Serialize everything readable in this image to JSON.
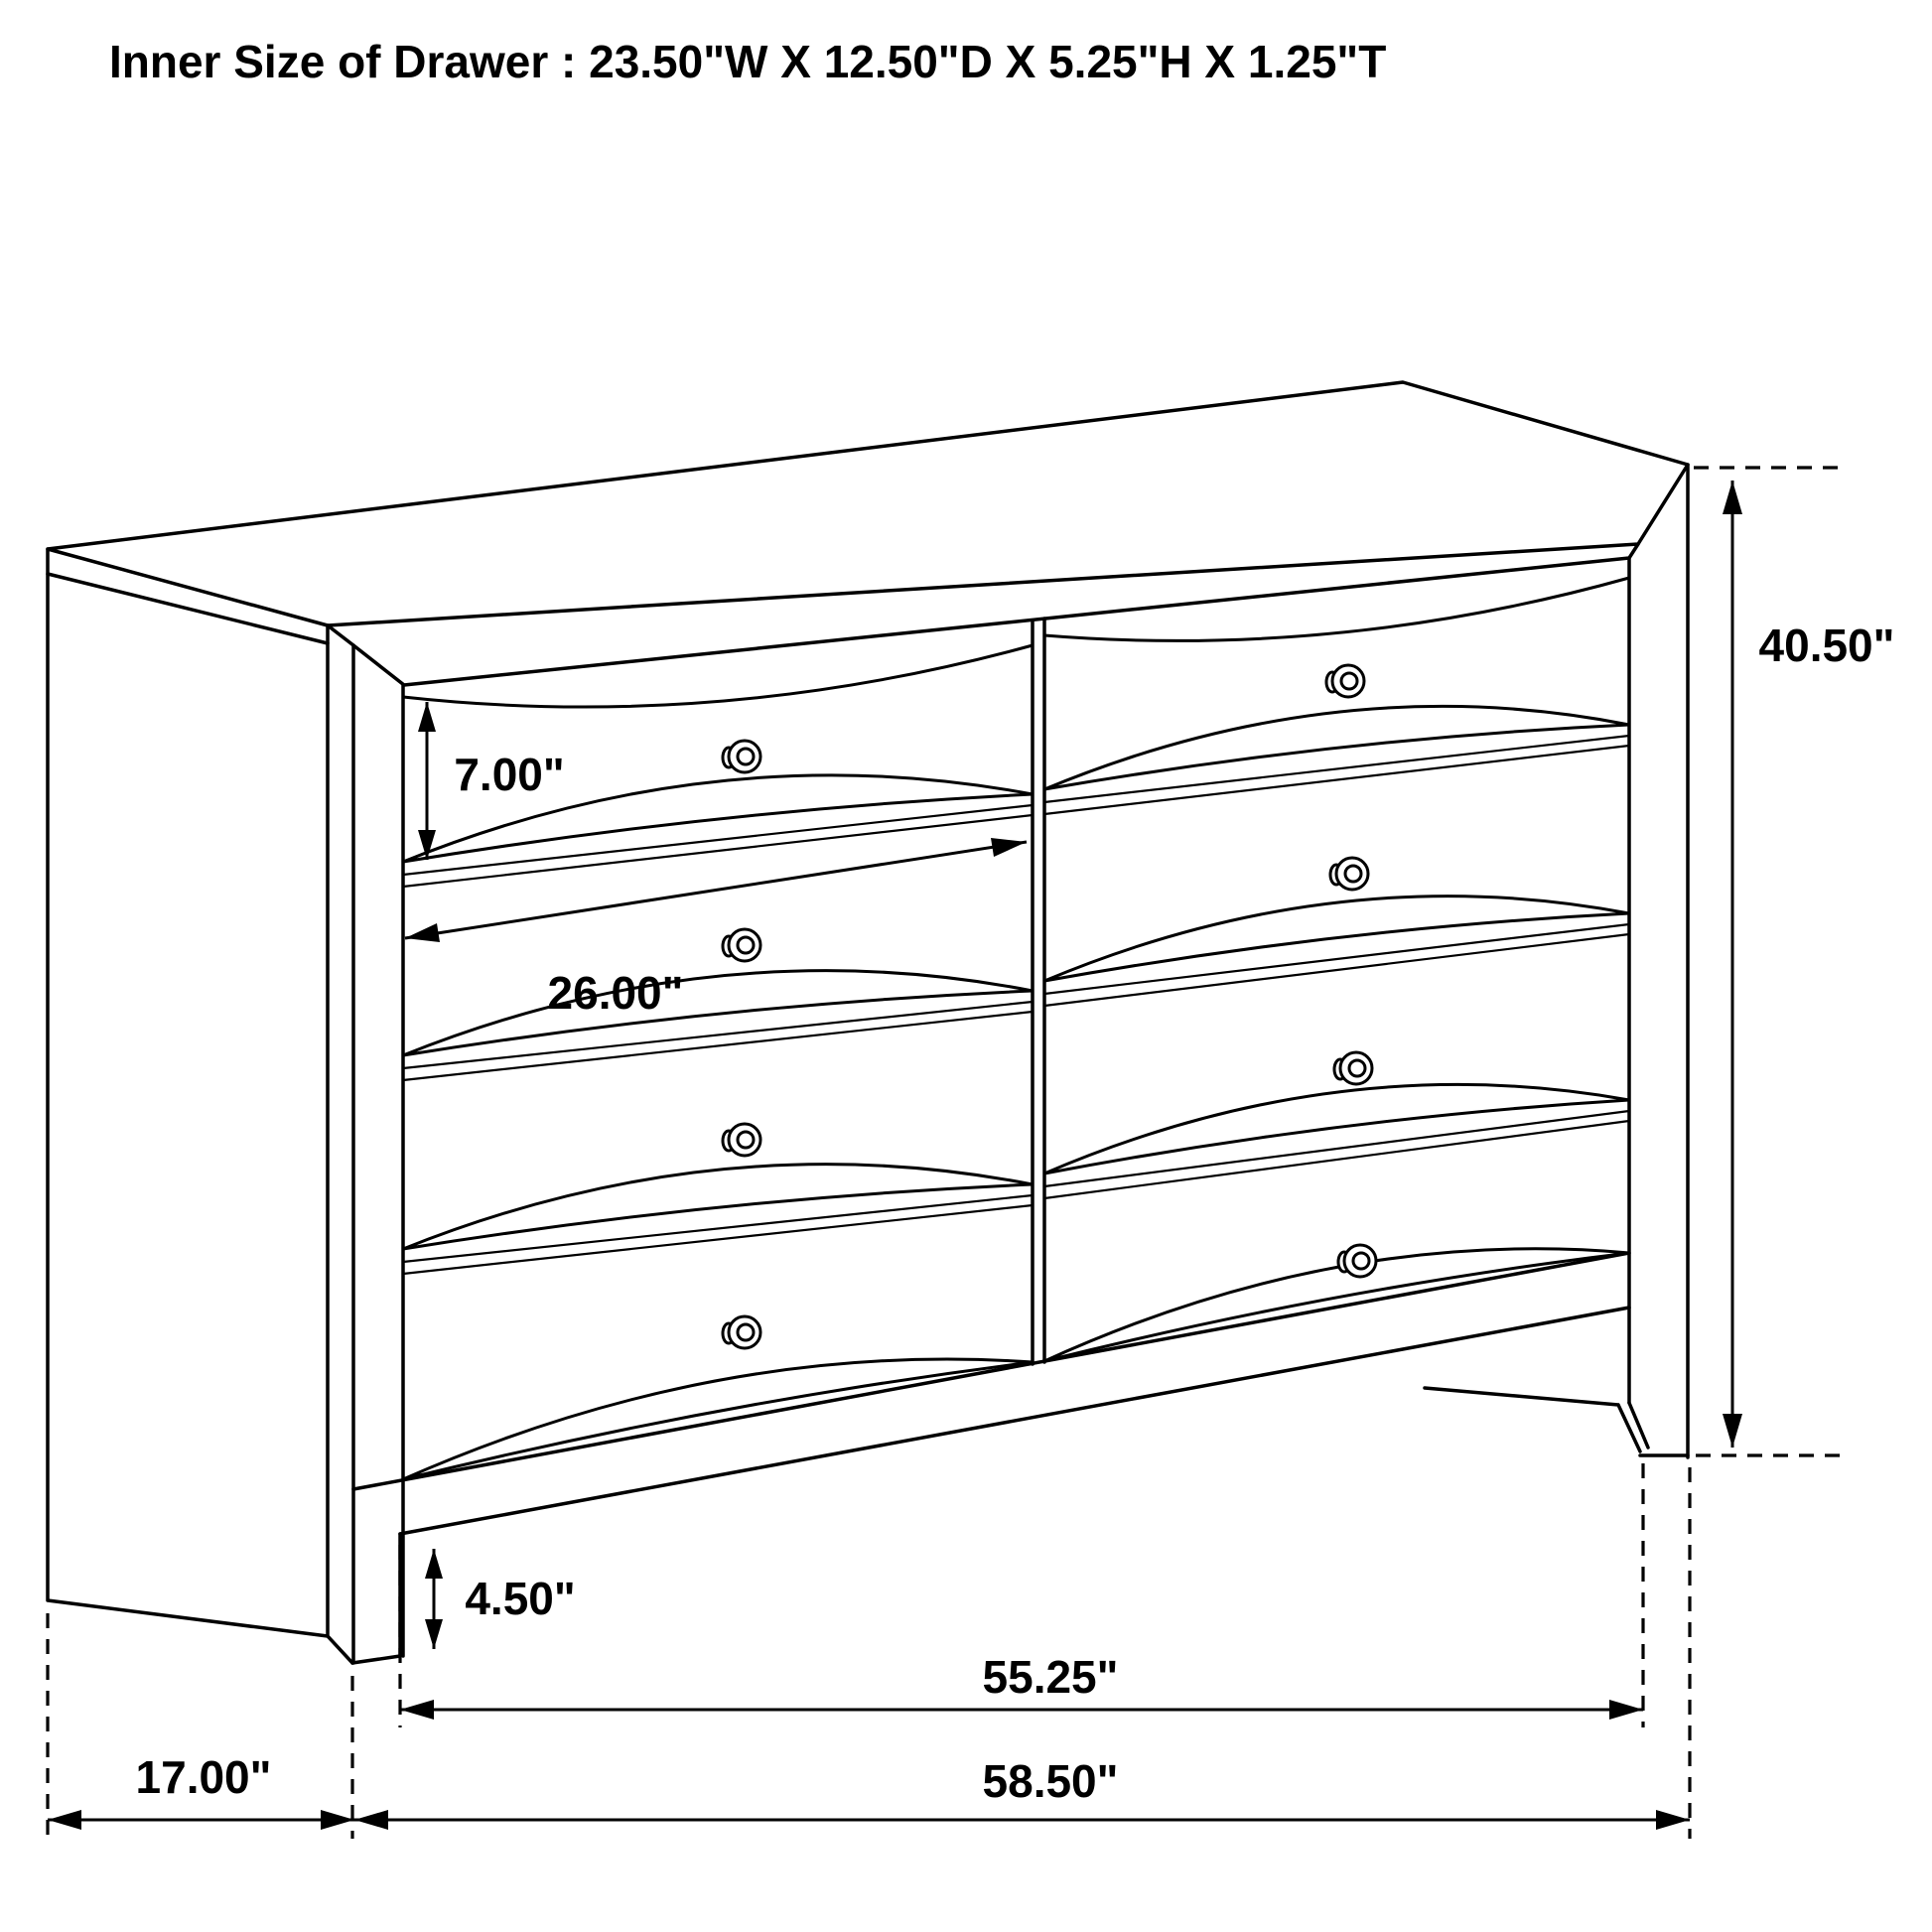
{
  "title": "Inner Size of Drawer : 23.50\"W X 12.50\"D X 5.25\"H X 1.25\"T",
  "figure": {
    "description": "Black-and-white technical line drawing of an eight-drawer dresser shown in front-left perspective with dimension callouts",
    "drawer_columns": 2,
    "drawer_rows": 4,
    "knob_count": 8,
    "line_color": "#000000",
    "background_color": "#ffffff"
  },
  "dimensions": {
    "drawer_height": "7.00\"",
    "drawer_width": "26.00\"",
    "overall_height": "40.50\"",
    "base_height": "4.50\"",
    "leg_span_width": "55.25\"",
    "depth": "17.00\"",
    "overall_width": "58.50\""
  }
}
